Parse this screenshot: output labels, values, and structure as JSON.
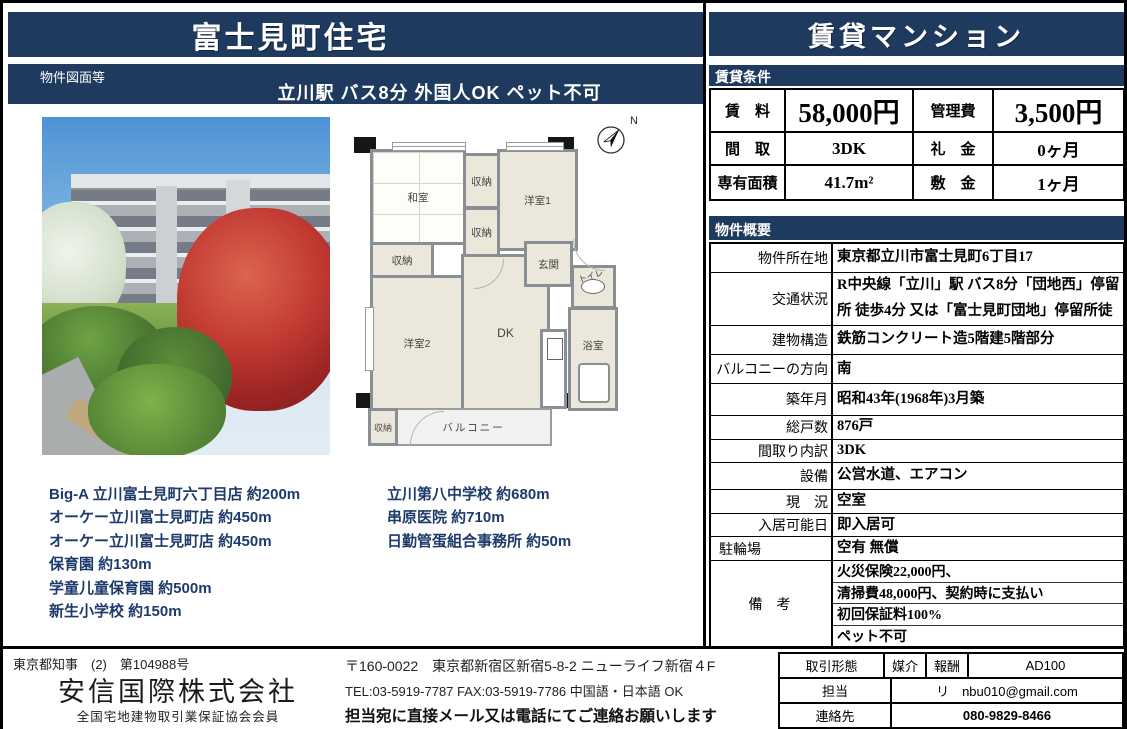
{
  "colors": {
    "navy": "#1e3a5e",
    "facility_text": "#1e3a6b"
  },
  "left": {
    "title": "富士見町住宅",
    "doc_label": "物件図面等",
    "subtitle": "立川駅 バス8分 外国人OK ペット不可",
    "facilities_left": [
      "Big-A 立川富士見町六丁目店 約200m",
      "オーケー立川富士見町店 約450m",
      "オーケー立川富士見町店 約450m",
      "保育園 約130m",
      "学童儿童保育園 約500m",
      "新生小学校 約150m"
    ],
    "facilities_right": [
      "立川第八中学校 約680m",
      "串原医院 約710m",
      "日勤管蛋組合事務所 約50m"
    ]
  },
  "floorplan": {
    "north_label": "N",
    "rooms": {
      "washitsu": "和室",
      "closet": "収納",
      "western1": "洋室1",
      "western2": "洋室2",
      "dk": "DK",
      "entrance": "玄関",
      "toilet": "トイレ",
      "bath": "浴室",
      "balcony": "バルコニー"
    }
  },
  "right": {
    "banner": "賃貸マンション",
    "rent_section": "賃貸条件",
    "rent": {
      "rows": [
        {
          "l1": "賃　料",
          "v1": "58,000円",
          "l2": "管理費",
          "v2": "3,500円"
        },
        {
          "l1": "間　取",
          "v1": "3DK",
          "l2": "礼　金",
          "v2": "0ヶ月"
        },
        {
          "l1": "専有面積",
          "v1": "41.7m²",
          "l2": "敷　金",
          "v2": "1ヶ月"
        }
      ]
    },
    "overview_section": "物件概要",
    "overview": {
      "rows": [
        {
          "label": "物件所在地",
          "value": "東京都立川市富士見町6丁目17"
        },
        {
          "label": "交通状況",
          "value": "R中央線「立川」駅 バス8分「団地西」停留所 徒歩4分 又は「富士見町団地」停留所徒"
        },
        {
          "label": "建物構造",
          "value": "鉄筋コンクリート造5階建5階部分"
        },
        {
          "label": "バルコニーの方向",
          "value": "南"
        },
        {
          "label": "築年月",
          "value": "昭和43年(1968年)3月築"
        },
        {
          "label": "総戸数",
          "value": "876戸"
        },
        {
          "label": "間取り内訳",
          "value": "3DK"
        },
        {
          "label": "設備",
          "value": "公営水道、エアコン"
        },
        {
          "label": "現　況",
          "value": "空室"
        },
        {
          "label": "入居可能日",
          "value": "即入居可"
        },
        {
          "label": "駐輪場",
          "value": "空有 無償"
        }
      ],
      "remarks_label": "備　考",
      "remarks": [
        "火災保険22,000円、",
        "清掃費48,000円、契約時に支払い",
        "初回保証料100%",
        "ペット不可"
      ]
    }
  },
  "footer": {
    "license": "東京都知事　(2)　第104988号",
    "company": "安信国際株式会社",
    "membership": "全国宅地建物取引業保証協会会員",
    "address": "〒160-0022　東京都新宿区新宿5-8-2 ニューライフ新宿４F",
    "tel_line": "TEL:03-5919-7787 FAX:03-5919-7786 中国語・日本語 OK",
    "notice": "担当宛に直接メール又は電話にてご連絡お願いします",
    "contact": {
      "deal_label": "取引形態",
      "deal_value": "媒介",
      "fee_label": "報酬",
      "fee_value": "AD100",
      "staff_label": "担当",
      "staff_value": "リ　nbu010@gmail.com",
      "contact_label": "連絡先",
      "contact_value": "080-9829-8466"
    }
  }
}
